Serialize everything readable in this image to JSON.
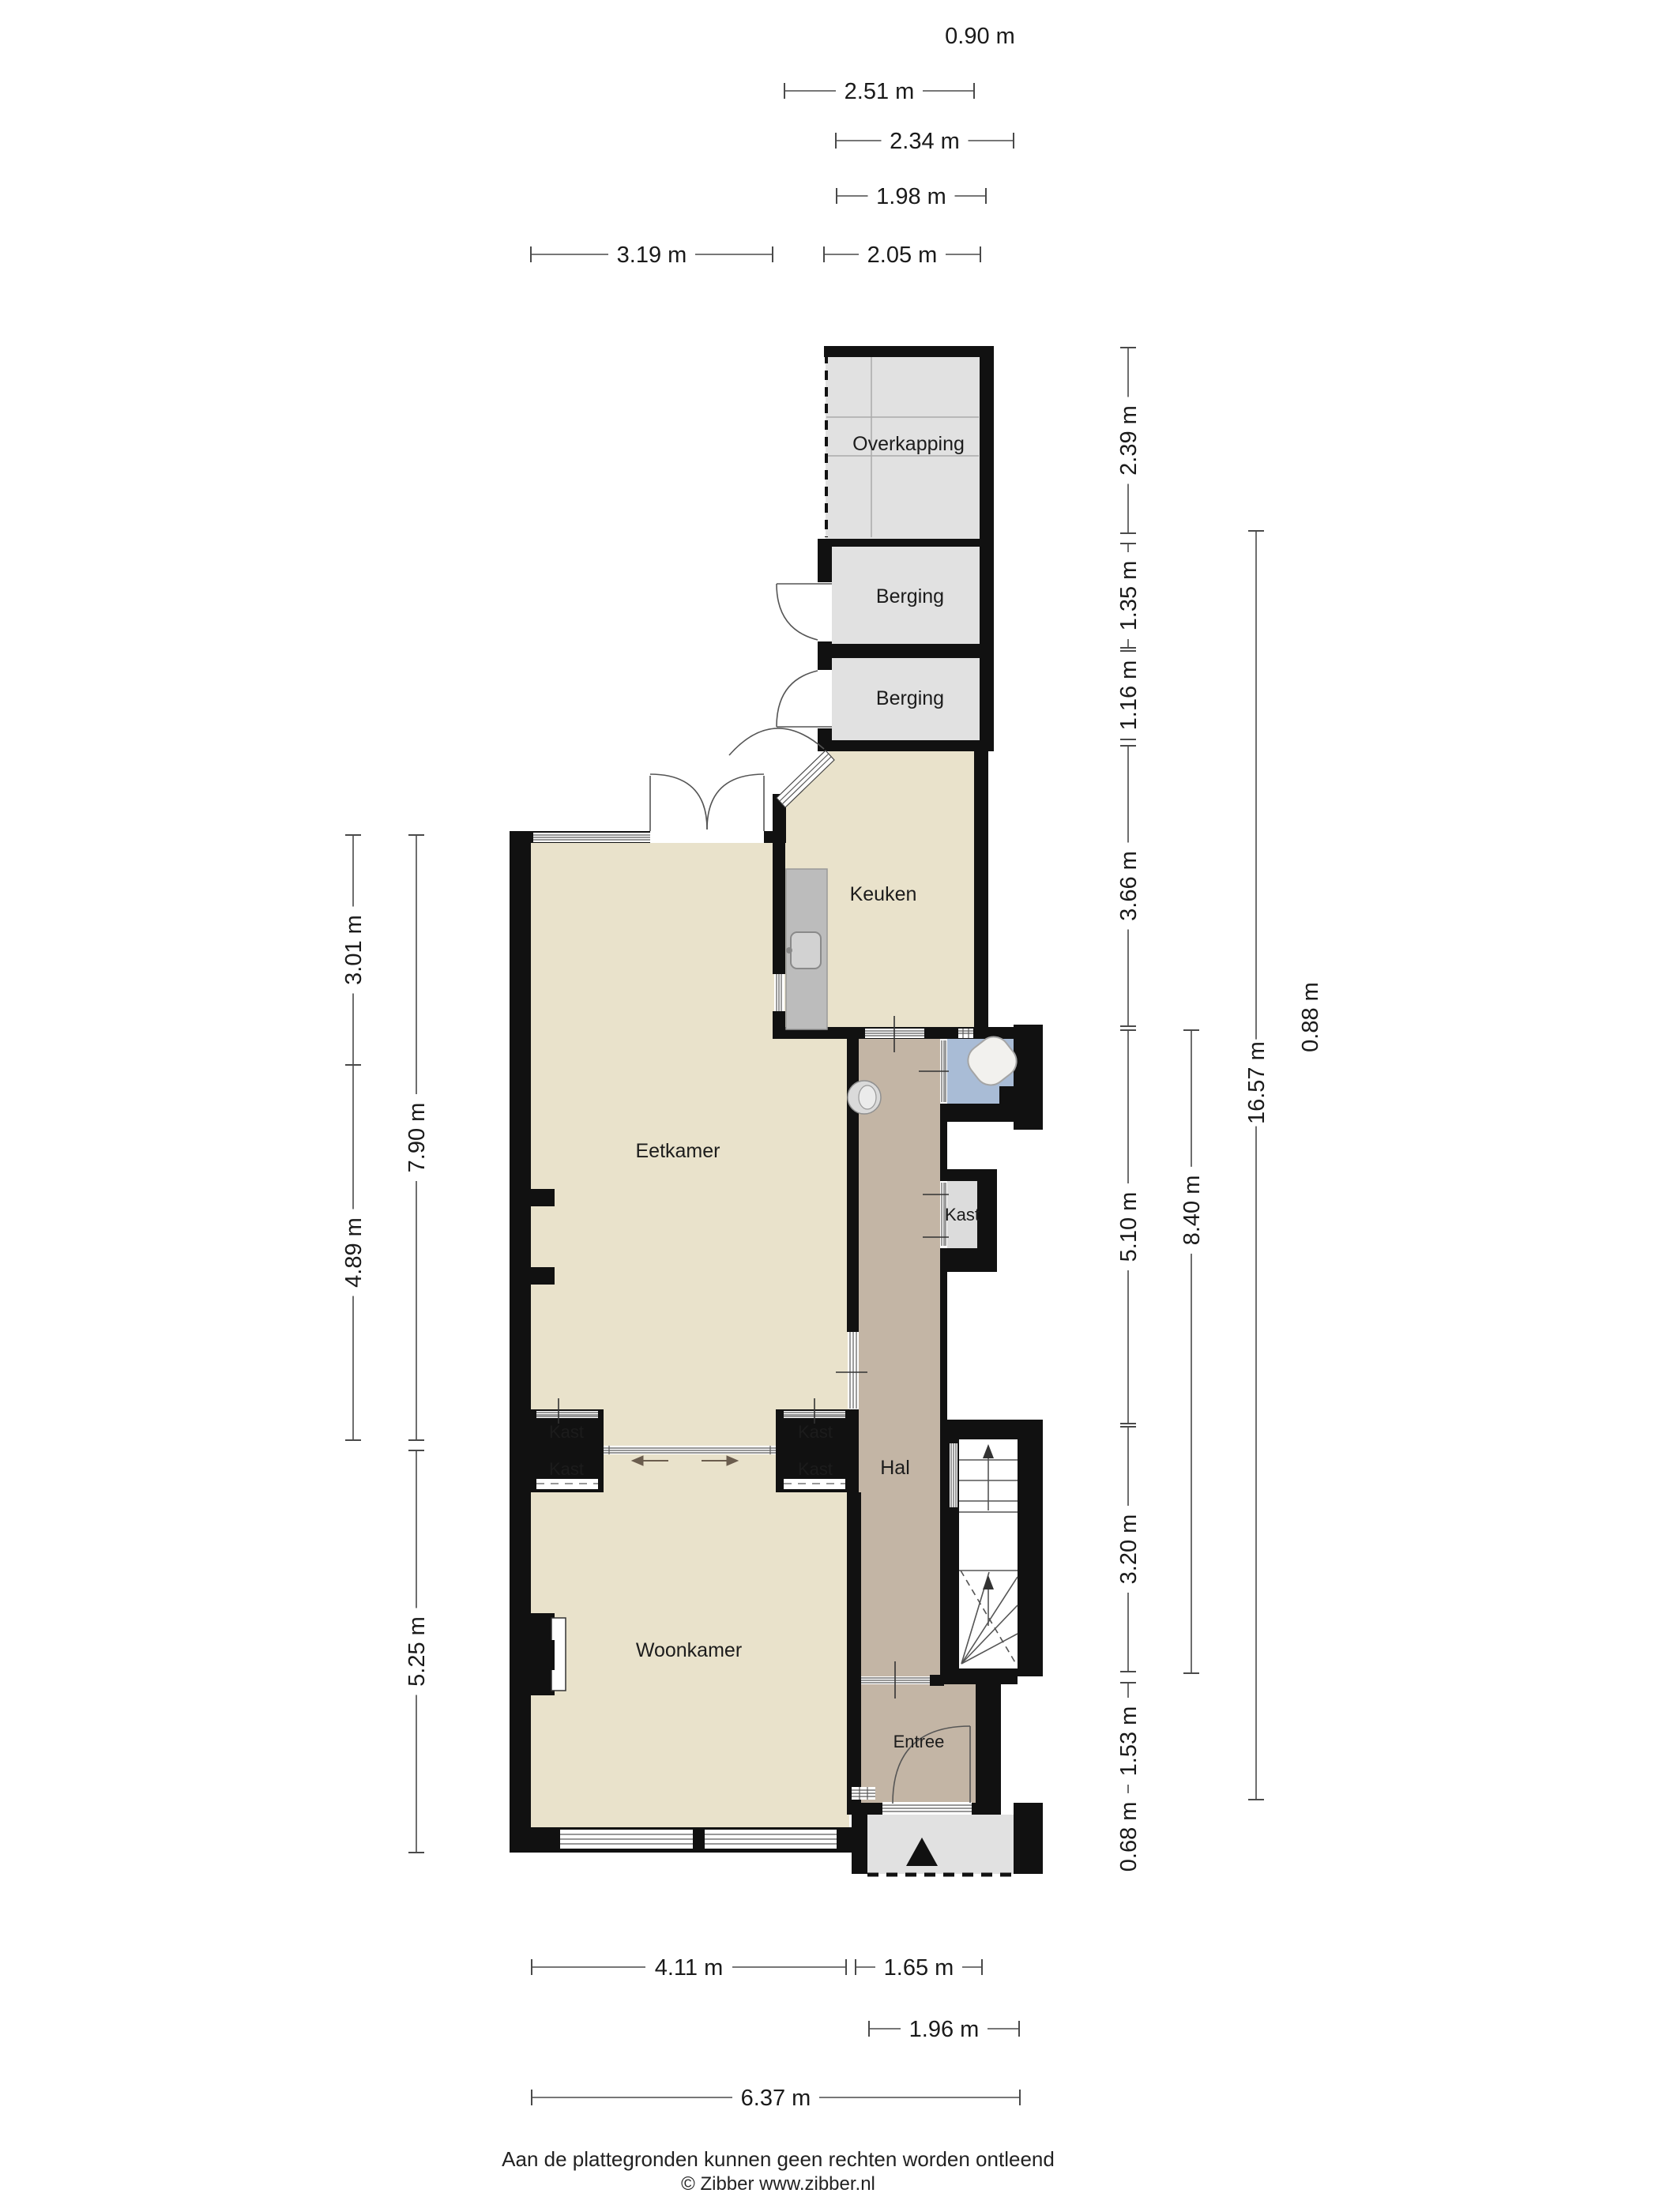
{
  "rooms": {
    "overkapping": "Overkapping",
    "berging_1": "Berging",
    "berging_2": "Berging",
    "keuken": "Keuken",
    "eetkamer": "Eetkamer",
    "woonkamer": "Woonkamer",
    "hal": "Hal",
    "entree": "Entree",
    "kast_1": "Kast",
    "kast_2": "Kast",
    "kast_3": "Kast",
    "kast_4": "Kast",
    "kast_5": "Kast"
  },
  "dims": {
    "d090": "0.90 m",
    "d251": "2.51 m",
    "d234": "2.34 m",
    "d198": "1.98 m",
    "d319": "3.19 m",
    "d205": "2.05 m",
    "d411": "4.11 m",
    "d165": "1.65 m",
    "d196": "1.96 m",
    "d637": "6.37 m",
    "d301": "3.01 m",
    "d489": "4.89 m",
    "d790": "7.90 m",
    "d525": "5.25 m",
    "d239": "2.39 m",
    "d135": "1.35 m",
    "d116": "1.16 m",
    "d366": "3.66 m",
    "d510": "5.10 m",
    "d320": "3.20 m",
    "d153": "1.53 m",
    "d068": "0.68 m",
    "d840": "8.40 m",
    "d1657": "16.57 m",
    "d088": "0.88 m"
  },
  "footer": {
    "line1": "Aan de plattegronden kunnen geen rechten worden ontleend",
    "line2": "© Zibber www.zibber.nl"
  },
  "colors": {
    "wall": "#111111",
    "floor_beige": "#e9e2cb",
    "floor_gray": "#e1e1e1",
    "floor_hal": "#c3b5a5",
    "floor_toilet": "#a9bcd6",
    "floor_kast": "#dcdcdc",
    "dim_line": "#4a4a4a"
  }
}
